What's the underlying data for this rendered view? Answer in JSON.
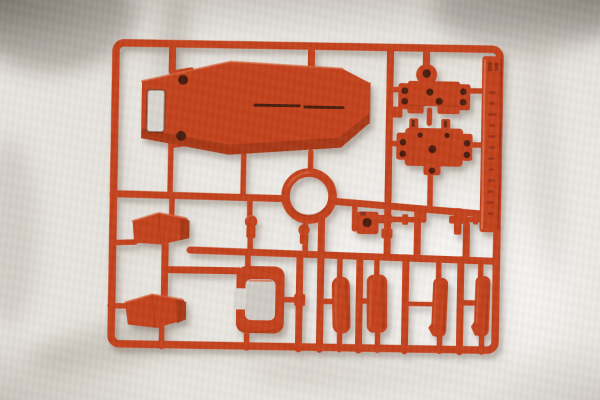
{
  "photo": {
    "subject": "Injection-molded model kit runner (sprue) of red-orange plastic parts",
    "surface": "white cloth with soft wrinkles",
    "lighting": "soft light from upper-left, shadows falling to lower-right"
  },
  "colors": {
    "plastic": "#c3431f",
    "plastic-light": "#d5653c",
    "plastic-dark": "#a43711",
    "hole": "#481b0b",
    "fabric": "#e8e4de",
    "fabric-dim": "#d9d5ce",
    "shadow": "#6e6052"
  },
  "runner": {
    "frame": "rectangular outer frame with inner cross rails and attachment gates",
    "tag": {
      "description": "molded runner tag strip on right edge with embossed vertical lettering",
      "text_legible": false
    },
    "parts": [
      {
        "id": "main-body-panel",
        "label": "large coffin-shaped hull panel with window cutout, two screw-hole tabs and a center slit"
      },
      {
        "id": "joint-block-top",
        "label": "joint block with winged sides and peg holes"
      },
      {
        "id": "joint-block-bottom",
        "label": "joint block with twin top prongs and peg holes"
      },
      {
        "id": "ring-part",
        "label": "circular ring"
      },
      {
        "id": "hoop-frame",
        "label": "rounded rectangular hoop with opening on left side"
      },
      {
        "id": "armor-plate-upper",
        "label": "angled armor plate"
      },
      {
        "id": "armor-plate-lower",
        "label": "angled armor plate"
      },
      {
        "id": "knob-small-left",
        "label": "small round-headed knob"
      },
      {
        "id": "knob-small-right",
        "label": "small round-headed knob"
      },
      {
        "id": "hook-bracket",
        "label": "bracket with round hole and side arm"
      },
      {
        "id": "pin-long",
        "label": "cylindrical pin with flange"
      },
      {
        "id": "cross-fitting",
        "label": "small cross-shaped fitting"
      },
      {
        "id": "pin-short",
        "label": "short cylindrical pin"
      },
      {
        "id": "blade-part-1",
        "label": "elongated rounded slab"
      },
      {
        "id": "blade-part-2",
        "label": "elongated rounded slab"
      },
      {
        "id": "blade-part-3",
        "label": "narrow elongated part with foot flare"
      },
      {
        "id": "blade-part-4",
        "label": "narrow elongated part with foot flare"
      }
    ]
  }
}
